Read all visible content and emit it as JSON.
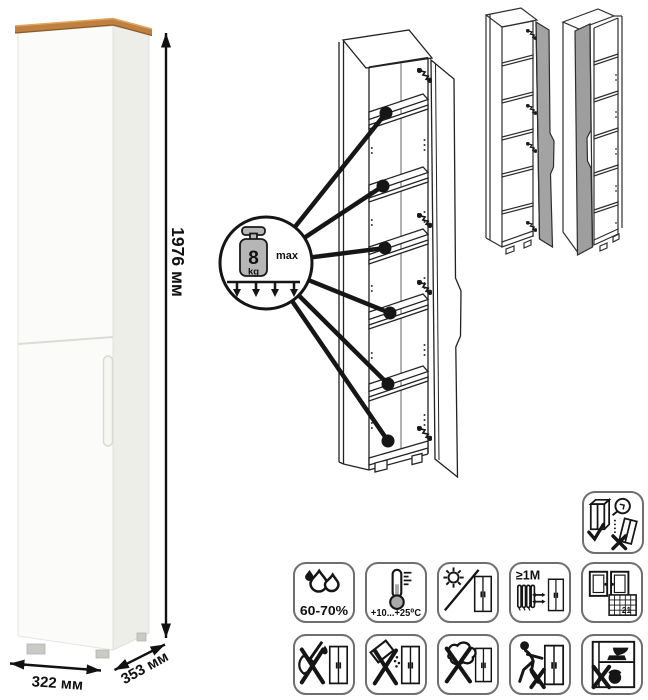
{
  "dimensions": {
    "height": "1976 мм",
    "width": "322 мм",
    "depth": "353 мм"
  },
  "shelf_load": {
    "value": "8",
    "unit": "kg",
    "qualifier": "max",
    "shelf_callouts": 6
  },
  "door_variants": {
    "variant_count": 2
  },
  "care_icons": {
    "wall_anchor": {
      "name": "anchor-to-wall-warning-icon"
    },
    "row1": [
      {
        "name": "humidity-icon",
        "label": "60-70%"
      },
      {
        "name": "temperature-icon",
        "label": "+10...+25⁰C"
      },
      {
        "name": "no-direct-sunlight-icon"
      },
      {
        "name": "radiator-distance-icon",
        "label": "≥1М"
      },
      {
        "name": "ventilation-calendar-icon",
        "label": "21"
      }
    ],
    "row2": [
      {
        "name": "no-sharp-impact-icon"
      },
      {
        "name": "no-abrasive-powder-icon"
      },
      {
        "name": "no-wet-sponge-icon"
      },
      {
        "name": "no-dragging-icon"
      },
      {
        "name": "no-overload-icon"
      }
    ]
  },
  "colors": {
    "wood_top": "#bf8040",
    "cabinet_side": "#edeee7",
    "door_gray": "#a3a3a3",
    "icon_border": "#6f6f6f",
    "line_art": "#1a1a1a"
  }
}
